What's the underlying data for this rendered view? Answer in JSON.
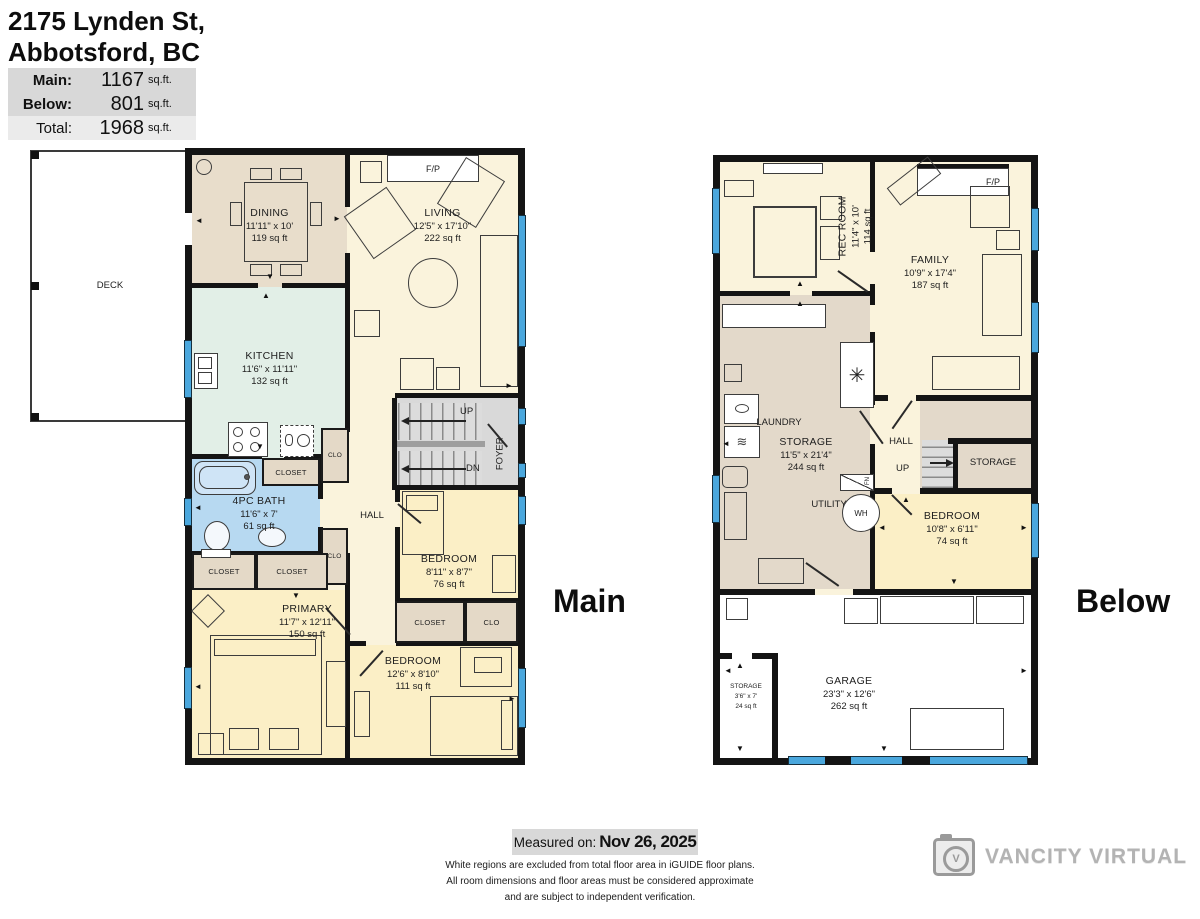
{
  "header": {
    "address_line1": "2175 Lynden St,",
    "address_line2": "Abbotsford, BC",
    "area_table": [
      {
        "label": "Main:",
        "value": "1167",
        "unit": "sq.ft."
      },
      {
        "label": "Below:",
        "value": "801",
        "unit": "sq.ft."
      },
      {
        "label": "Total:",
        "value": "1968",
        "unit": "sq.ft."
      }
    ]
  },
  "floor_labels": {
    "main": "Main",
    "below": "Below"
  },
  "main_floor": {
    "deck_label": "DECK",
    "fireplace_label": "F/P",
    "dining": {
      "name": "DINING",
      "dims": "11'11\" x 10'",
      "area": "119 sq ft"
    },
    "living": {
      "name": "LIVING",
      "dims": "12'5\" x 17'10\"",
      "area": "222 sq ft"
    },
    "kitchen": {
      "name": "KITCHEN",
      "dims": "11'6\" x 11'11\"",
      "area": "132 sq ft"
    },
    "bath": {
      "name": "4PC BATH",
      "dims": "11'6\" x 7'",
      "area": "61 sq ft"
    },
    "bedroom_mid": {
      "name": "BEDROOM",
      "dims": "8'11\" x 8'7\"",
      "area": "76 sq ft"
    },
    "primary": {
      "name": "PRIMARY",
      "dims": "11'7\" x 12'11\"",
      "area": "150 sq ft"
    },
    "bedroom_bottom": {
      "name": "BEDROOM",
      "dims": "12'6\" x 8'10\"",
      "area": "111 sq ft"
    },
    "hall_label": "HALL",
    "foyer_label": "FOYER",
    "up_label": "UP",
    "dn_label": "DN",
    "closet_labels": {
      "closet": "CLOSET",
      "clo": "CLO"
    }
  },
  "below_floor": {
    "fireplace_label": "F/P",
    "rec_room": {
      "name": "REC ROOM",
      "dims": "11'4\" x 10'",
      "area": "114 sq ft"
    },
    "family": {
      "name": "FAMILY",
      "dims": "10'9\" x 17'4\"",
      "area": "187 sq ft"
    },
    "storage_main": {
      "name": "STORAGE",
      "dims": "11'5\" x 21'4\"",
      "area": "244 sq ft"
    },
    "bedroom": {
      "name": "BEDROOM",
      "dims": "10'8\" x 6'11\"",
      "area": "74 sq ft"
    },
    "garage": {
      "name": "GARAGE",
      "dims": "23'3\" x 12'6\"",
      "area": "262 sq ft"
    },
    "storage_small": {
      "name": "STORAGE",
      "dims": "3'6\" x 7'",
      "area": "24 sq ft"
    },
    "laundry_label": "LAUNDRY",
    "utility_label": "UTILITY",
    "wh_label": "WH",
    "fn_label": "FN",
    "hall_label": "HALL",
    "up_label": "UP",
    "storage_right_label": "STORAGE"
  },
  "footer": {
    "measured_label": "Measured on:",
    "measured_date": "Nov 26, 2025",
    "disclaimer_lines": [
      "White regions are excluded from total floor area in iGUIDE floor plans.",
      "All room dimensions and floor areas must be considered approximate",
      "and are subject to independent verification."
    ],
    "brand": "VANCITY VIRTUAL"
  },
  "legend_colors": {
    "wall": "#141414",
    "window": "#4aa7dd",
    "room_cream": "#faf3dc",
    "room_tan": "#e8ddcb",
    "room_mint": "#e2efe7",
    "room_blue": "#b7d9f1",
    "room_yellow": "#fbefc6",
    "closet_tan": "#e4d9c7",
    "stairs_gray": "#d9d9d9",
    "storage_tan": "#e3d9ca"
  }
}
